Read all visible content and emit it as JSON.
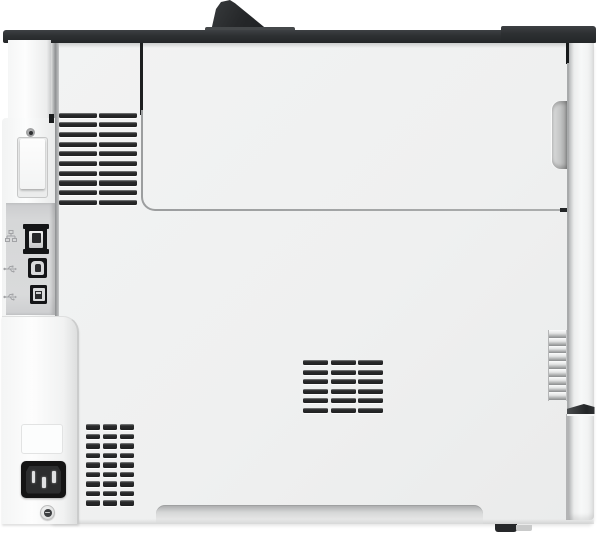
{
  "scene": {
    "description": "Rear view photograph of a white laser printer",
    "background_color": "#ffffff"
  },
  "printer": {
    "colors": {
      "top_edge": "#2c2f31",
      "body": "#eff0f0",
      "left_column": "#fbfcfc",
      "interface_panel": "#d6d7d8",
      "vent_slot": "#252627",
      "side_panel": "#f4f5f5",
      "power_inlet": "#141414",
      "foot": "#26282a"
    },
    "interface_ports": [
      {
        "id": "ethernet-port",
        "icon": "ethernet-icon"
      },
      {
        "id": "usb-b-port",
        "icon": "usb-icon"
      },
      {
        "id": "usb-a-port",
        "icon": "usb-icon"
      }
    ],
    "vents": [
      {
        "name": "vent-grille-upper-left",
        "x": 59,
        "y": 112.5,
        "col_offsets": [
          0,
          40
        ],
        "slot_width": 38,
        "rows": 10,
        "row_pitch": 9.7,
        "slot_height": 5.2
      },
      {
        "name": "vent-grille-lower-left",
        "x": 86,
        "y": 424,
        "col_offsets": [
          0,
          17,
          34
        ],
        "slot_width": 14,
        "rows": 9,
        "row_pitch": 9.5,
        "slot_height": 5.5
      },
      {
        "name": "vent-grille-center",
        "x": 303,
        "y": 360,
        "col_offsets": [
          0,
          27.5,
          55
        ],
        "slot_width": 25,
        "rows": 6,
        "row_pitch": 9.6,
        "slot_height": 5
      }
    ],
    "side_slats": {
      "name": "side-vent-slats",
      "rows": 9,
      "row_pitch": 7.8
    },
    "screws": 2,
    "feet": 1
  }
}
